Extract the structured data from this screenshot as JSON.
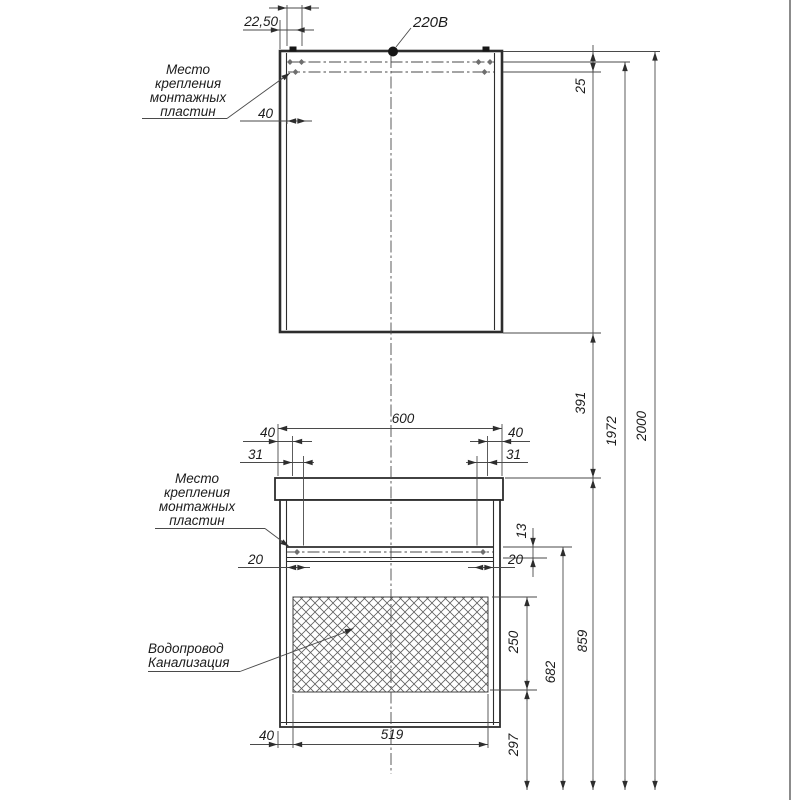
{
  "labels": {
    "power": "220В",
    "mount_top": [
      "Место",
      "крепления",
      "монтажных",
      "пластин"
    ],
    "mount_bottom": [
      "Место",
      "крепления",
      "монтажных",
      "пластин"
    ],
    "plumbing": [
      "Водопровод",
      "Канализация"
    ]
  },
  "dims": {
    "d2250": "22,50",
    "d40top": "40",
    "d25": "25",
    "d391": "391",
    "d1972": "1972",
    "d2000": "2000",
    "d600": "600",
    "d40l": "40",
    "d40r": "40",
    "d31l": "31",
    "d31r": "31",
    "d20l": "20",
    "d20r": "20",
    "d13": "13",
    "d250": "250",
    "d682": "682",
    "d859": "859",
    "d297": "297",
    "d519": "519",
    "d40b": "40"
  },
  "colors": {
    "background": "#ffffff",
    "line": "#2d2d2d",
    "thin_line": "#4a4a4a",
    "text": "#1c1c1c"
  }
}
